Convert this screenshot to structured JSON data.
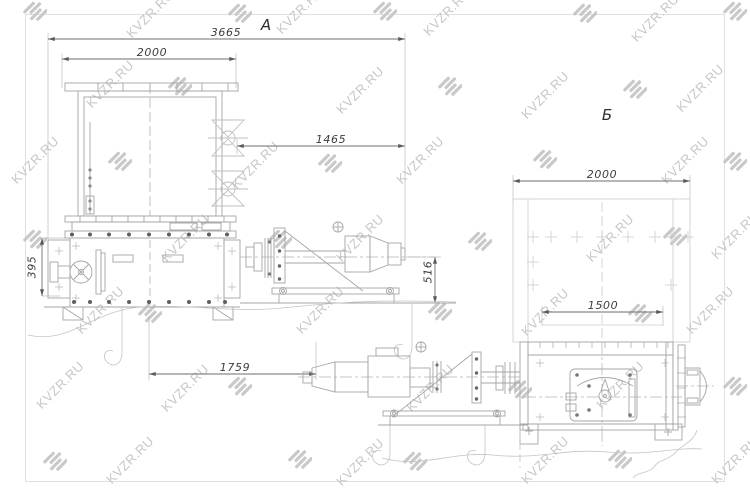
{
  "watermark": {
    "text": "KVZR.RU",
    "color": "#c7c7c7",
    "text_positions": [
      [
        150,
        14
      ],
      [
        300,
        10
      ],
      [
        447,
        12
      ],
      [
        655,
        18
      ],
      [
        110,
        84
      ],
      [
        360,
        90
      ],
      [
        545,
        95
      ],
      [
        700,
        88
      ],
      [
        35,
        160
      ],
      [
        255,
        165
      ],
      [
        420,
        160
      ],
      [
        685,
        160
      ],
      [
        185,
        238
      ],
      [
        360,
        238
      ],
      [
        610,
        238
      ],
      [
        735,
        235
      ],
      [
        100,
        310
      ],
      [
        320,
        310
      ],
      [
        545,
        312
      ],
      [
        710,
        310
      ],
      [
        60,
        385
      ],
      [
        185,
        388
      ],
      [
        430,
        388
      ],
      [
        620,
        385
      ],
      [
        130,
        460
      ],
      [
        360,
        462
      ],
      [
        545,
        460
      ],
      [
        735,
        460
      ]
    ],
    "logo_positions": [
      [
        35,
        10
      ],
      [
        240,
        12
      ],
      [
        385,
        10
      ],
      [
        585,
        12
      ],
      [
        735,
        10
      ],
      [
        180,
        85
      ],
      [
        450,
        85
      ],
      [
        635,
        88
      ],
      [
        120,
        160
      ],
      [
        330,
        162
      ],
      [
        545,
        158
      ],
      [
        735,
        160
      ],
      [
        35,
        238
      ],
      [
        280,
        238
      ],
      [
        480,
        240
      ],
      [
        675,
        235
      ],
      [
        150,
        312
      ],
      [
        440,
        310
      ],
      [
        640,
        312
      ],
      [
        240,
        385
      ],
      [
        520,
        388
      ],
      [
        735,
        385
      ],
      [
        55,
        460
      ],
      [
        300,
        458
      ],
      [
        415,
        460
      ],
      [
        620,
        458
      ]
    ]
  },
  "views": {
    "a": {
      "label": "А",
      "dims": {
        "overall_length": "3665",
        "tank_width": "2000",
        "drive_length": "1465",
        "drive_axis_height": "516",
        "inlet_offset": "395",
        "base_length": "1759"
      }
    },
    "b": {
      "label": "Б",
      "dims": {
        "overall_width": "2000",
        "body_width": "1500"
      }
    }
  }
}
